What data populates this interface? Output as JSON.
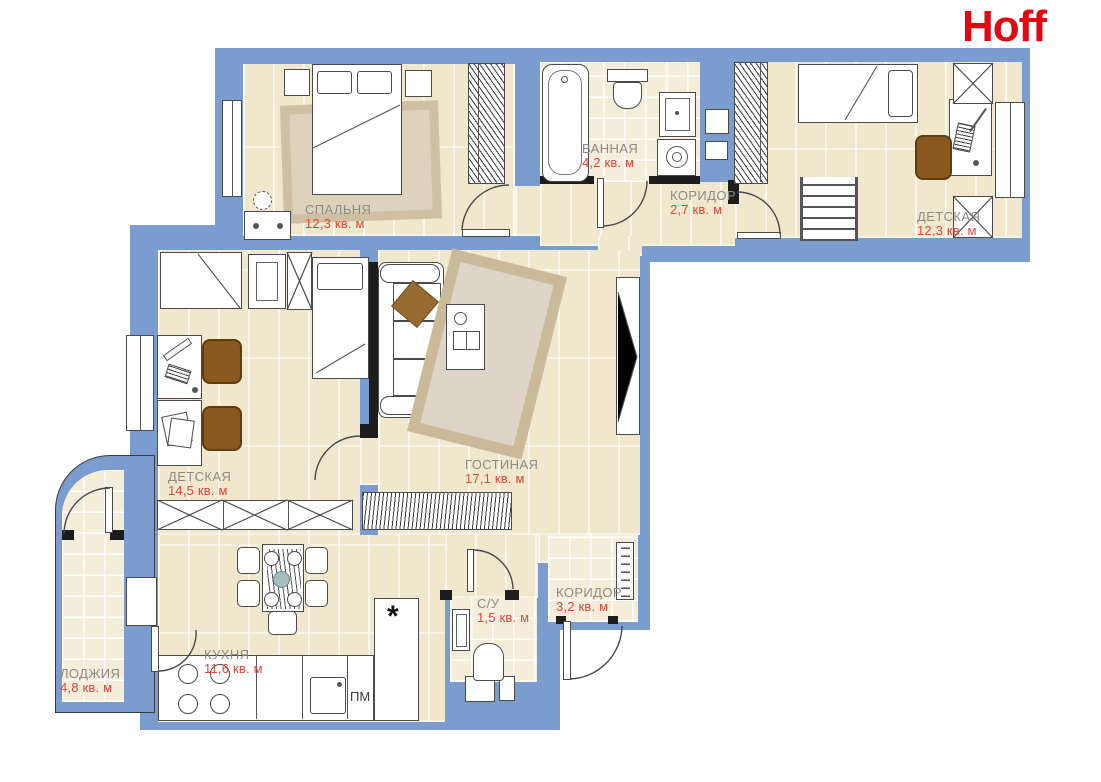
{
  "logo": {
    "text": "Hoff"
  },
  "rooms": [
    {
      "id": "bedroom",
      "name": "СПАЛЬНЯ",
      "area": "12,3 кв. м"
    },
    {
      "id": "bathroom",
      "name": "ВАННАЯ",
      "area": "4,2 кв. м"
    },
    {
      "id": "corridor-top",
      "name": "КОРИДОР",
      "area": "2,7 кв. м"
    },
    {
      "id": "kids-right",
      "name": "ДЕТСКАЯ",
      "area": "12,3 кв. м"
    },
    {
      "id": "kids-left",
      "name": "ДЕТСКАЯ",
      "area": "14,5 кв. м"
    },
    {
      "id": "living",
      "name": "ГОСТИНАЯ",
      "area": "17,1 кв. м"
    },
    {
      "id": "wc",
      "name": "С/У",
      "area": "1,5 кв. м"
    },
    {
      "id": "corridor-entry",
      "name": "КОРИДОР",
      "area": "3,2 кв. м"
    },
    {
      "id": "kitchen",
      "name": "КУХНЯ",
      "area": "11,6 кв. м"
    },
    {
      "id": "loggia",
      "name": "ЛОДЖИЯ",
      "area": "4,8 кв. м"
    }
  ],
  "appliances": {
    "dishwasher_label": "ПМ",
    "fridge_symbol": "*"
  },
  "colors": {
    "blue": "#7b9cce",
    "floorBeige": "#f0e7cc",
    "tileBeige": "#f3edda",
    "labelGray": "#8b8b84",
    "areaRed": "#e2453a",
    "logoRed": "#e30613",
    "chairBrown": "#8a581e",
    "rugBeige": "#cfc0a3"
  }
}
